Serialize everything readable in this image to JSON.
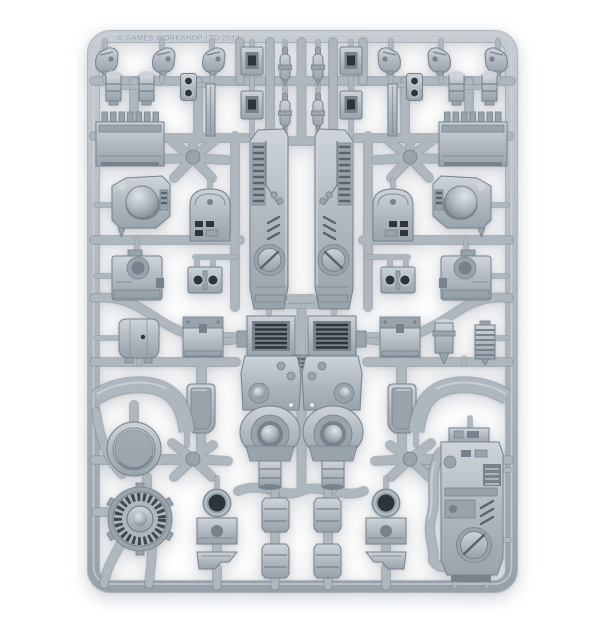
{
  "image": {
    "type": "product-photo",
    "subject": "Grey plastic model-kit sprue (frame of unassembled miniature terrain/vehicle parts) photographed on a white studio background",
    "orientation": "portrait",
    "symmetry": "left and right halves are mirrored around a central spine"
  },
  "sprue": {
    "embossed_text": "© GAMES WORKSHOP LTD 2014",
    "material": "light grey polystyrene plastic",
    "parts": [
      {
        "id": "armour-tower",
        "label": "tall finned tower panel with circular hatch",
        "count": 2
      },
      {
        "id": "pump-assembly",
        "label": "louvred pump body with domed circular port and nozzle",
        "count": 2
      },
      {
        "id": "vent-block",
        "label": "ribbed vent housing",
        "count": 2
      },
      {
        "id": "dome-turret",
        "label": "housing with hemispherical dome",
        "count": 2
      },
      {
        "id": "boss-block",
        "label": "housing with flat circular boss",
        "count": 2
      },
      {
        "id": "slot-panel",
        "label": "round-topped panel with dark slots",
        "count": 2
      },
      {
        "id": "twin-hole-block",
        "label": "block with two socket holes",
        "count": 2
      },
      {
        "id": "hatch-shield",
        "label": "shield-shaped hatch door",
        "count": 2
      },
      {
        "id": "fender-arc",
        "label": "curved fender band",
        "count": 2
      },
      {
        "id": "exhaust-head",
        "label": "small nozzle head",
        "count": 6
      },
      {
        "id": "canister",
        "label": "small cylindrical canister",
        "count": 4
      },
      {
        "id": "piston-capsule",
        "label": "piston capsule",
        "count": 4
      },
      {
        "id": "socket-block",
        "label": "block with recessed square socket",
        "count": 4
      },
      {
        "id": "bolt-plate",
        "label": "plate with two bolt holes",
        "count": 2
      },
      {
        "id": "girder-strip",
        "label": "thin girder strip",
        "count": 2
      },
      {
        "id": "storage-crate",
        "label": "lidded crate",
        "count": 2
      },
      {
        "id": "rounded-tank",
        "label": "rounded tank",
        "count": 1
      },
      {
        "id": "small-pump",
        "label": "small pump cylinder",
        "count": 1
      },
      {
        "id": "finned-cylinder",
        "label": "ribbed heat-sink cylinder",
        "count": 1
      },
      {
        "id": "ring-mount",
        "label": "ring mount on base block",
        "count": 2
      },
      {
        "id": "wedge-plate",
        "label": "angled wedge plate",
        "count": 2
      },
      {
        "id": "small-box",
        "label": "small grooved box",
        "count": 4
      },
      {
        "id": "round-dish",
        "label": "plain circular dish",
        "count": 1
      },
      {
        "id": "turbofan-vent",
        "label": "circular turbofan vent with radial blades and pipe legs",
        "count": 1
      },
      {
        "id": "engine-unit",
        "label": "large engine unit with circular hatch and external hose",
        "count": 1
      }
    ]
  },
  "palette": {
    "background": "#ffffff",
    "plastic_base": "#aeb6be",
    "plastic_light": "#ced4d9",
    "plastic_mid": "#99a3ac",
    "plastic_dark": "#77828c",
    "plastic_deep": "#59636d",
    "recess": "#2e343a",
    "runner_edge": "#848e98"
  }
}
